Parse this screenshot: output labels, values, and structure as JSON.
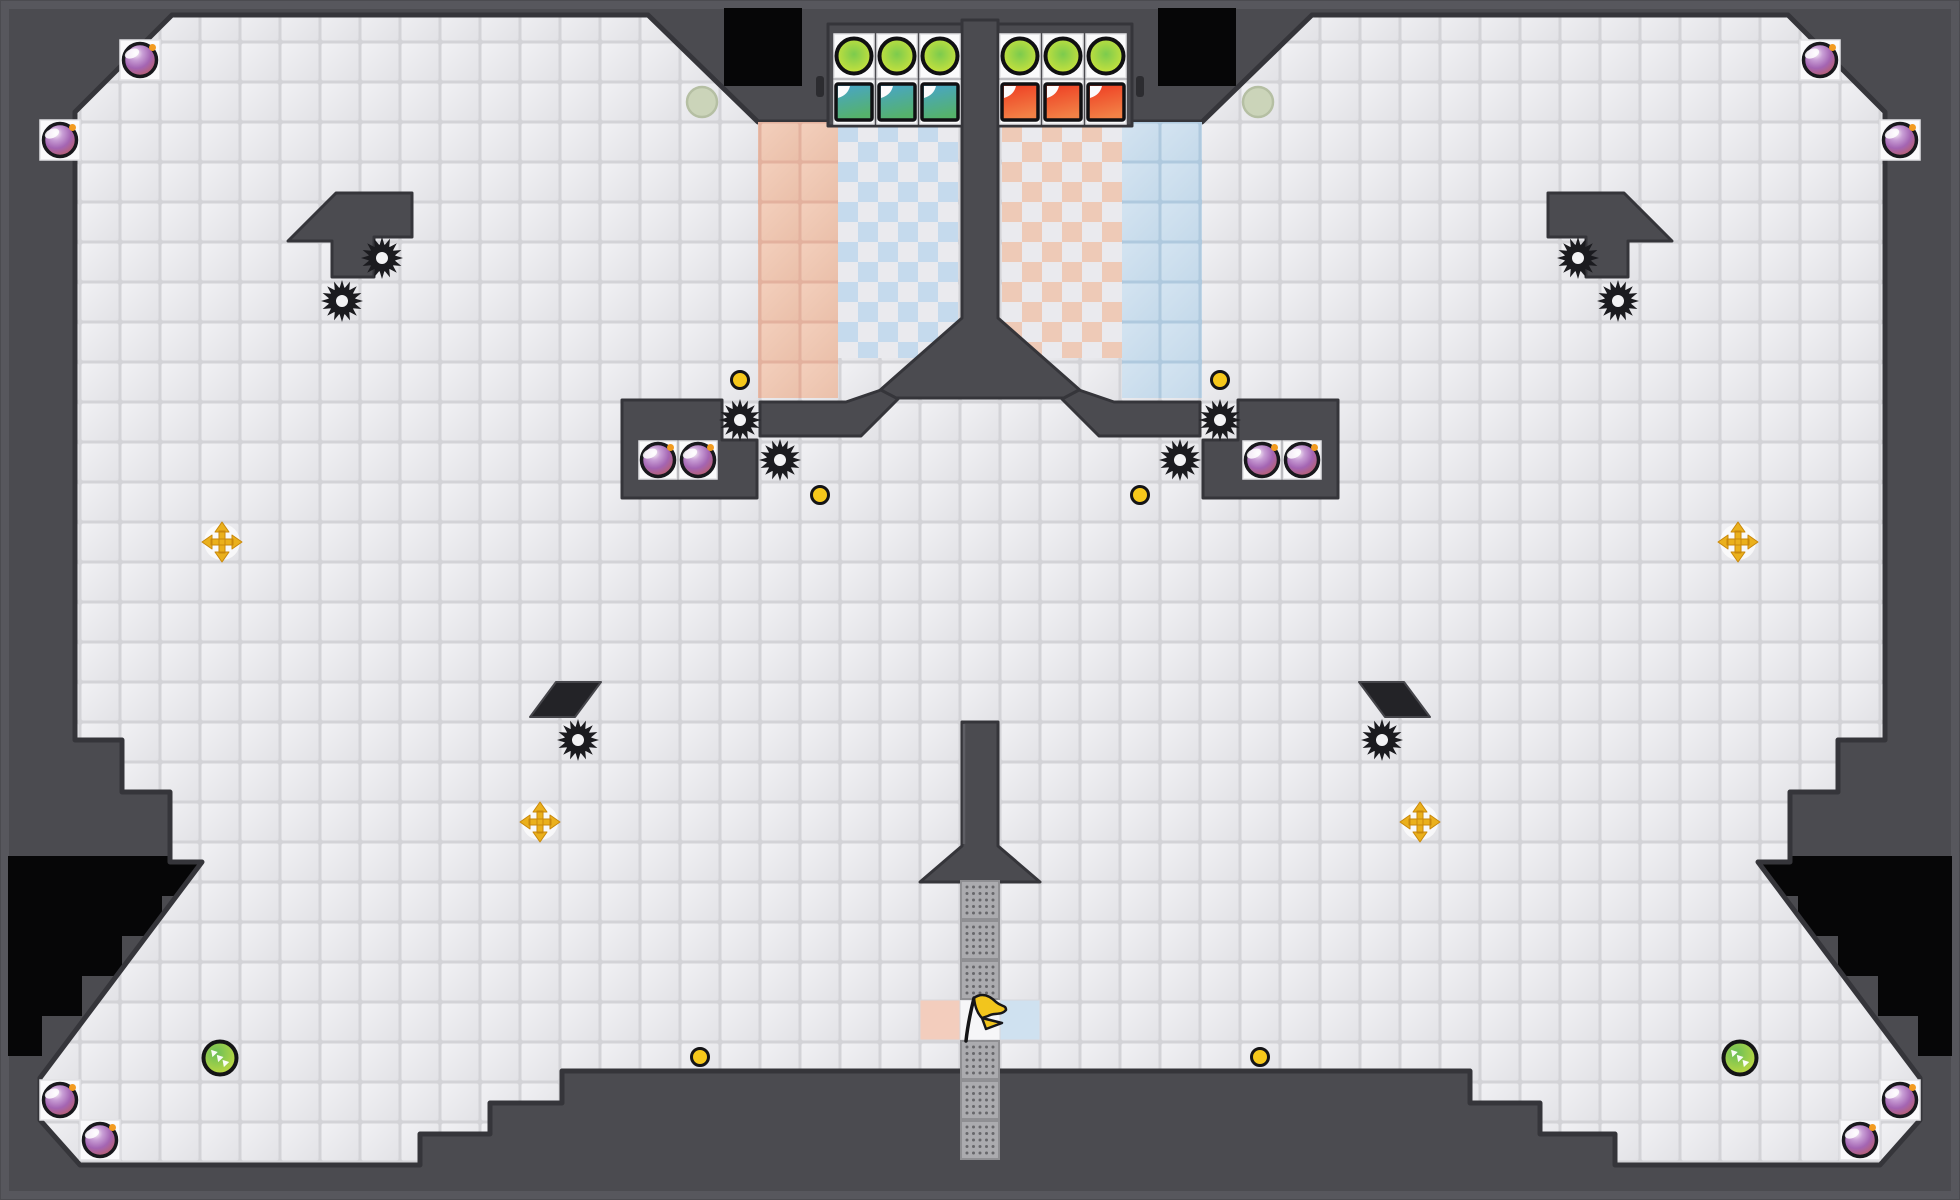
{
  "scene": {
    "width": 1960,
    "height": 1200,
    "mode_hint": "capture-the-flag-arena"
  },
  "colors": {
    "wall": "#4b4b50",
    "wallEdge": "#35353a",
    "wallHi": "#5e5e64",
    "voidBlack": "#060607",
    "rim": "#57575d",
    "tileSeam": "#d3d3d7",
    "tileHi": "#f1f1f4",
    "tileLo": "#e2e2e6",
    "whiteCell": "#fafafb",
    "whiteCellEdge": "#e2e2e5",
    "peachSeam": "#e3b19e",
    "peachA": "#f3cfbc",
    "peachB": "#eabfa9",
    "blueSeam": "#afc9de",
    "blueA": "#d4e4f1",
    "blueB": "#c4d9ea",
    "checkBlue": "#c5daed",
    "checkPeach": "#eecab7",
    "checkBase": "#eaeaee",
    "mesh": "#ababaf",
    "meshEdge": "#8f8f93",
    "meshDot": "#67676b",
    "bombRing": "#19191d",
    "spark": "#f29b1f",
    "coin": "#f6c81b",
    "coinRing": "#141416",
    "gold": "#eab01c",
    "goldEdge": "#c9880b",
    "gear": "#1b1b1f",
    "gearHole": "#f3f3f5",
    "btnIn": "#7ccb4d",
    "btnMid": "#b5dc41",
    "btnOut": "#e9ef2a",
    "tealA": "#47a4cf",
    "tealB": "#55b26b",
    "redA": "#ee3a21",
    "redB": "#f28146",
    "padA": "#6abf58",
    "padB": "#d9e038",
    "pale": "#cbd4b9",
    "paleEdge": "#b5bfa3",
    "pink": "#f3cdbd",
    "lightblue": "#cfe1f0",
    "flagCell": "#f6f6f8",
    "flagYellow": "#f2c51d",
    "sliver": "#232327",
    "bombStops": [
      "#f9f3f7",
      "#c99fd6",
      "#a465b3",
      "#b85f73",
      "#ca6b4e"
    ]
  },
  "level": {
    "cavity_path": "M172,15 L648,15 L758,122 L1202,122 L1312,15 L1788,15 L1885,112 L1885,740 L1838,740 L1838,792 L1790,792 L1790,862 L1758,862 L1920,1078 L1920,1120 L1880,1165 L1615,1165 L1615,1134 L1540,1134 L1540,1103 L1470,1103 L1470,1071 L562,1071 L562,1103 L490,1103 L490,1134 L420,1134 L420,1165 L80,1165 L40,1120 L40,1078 L202,862 L170,862 L170,792 L122,792 L122,740 L75,740 L75,112 Z",
    "voids": [
      {
        "name": "void-top-left",
        "path": "M724,8 h78 v78 h-78 Z"
      },
      {
        "name": "void-top-right",
        "path": "M1158,8 h78 v78 h-78 Z"
      },
      {
        "name": "void-bottom-left",
        "path": "M8,856 L202,856 L202,896 L162,896 L162,936 L122,936 L122,976 L82,976 L82,1016 L42,1016 L42,1056 L8,1056 Z"
      },
      {
        "name": "void-bottom-right",
        "path": "M1952,856 L1758,856 L1758,896 L1798,896 L1798,936 L1838,936 L1838,976 L1878,976 L1878,1016 L1918,1016 L1918,1056 L1952,1056 Z"
      }
    ],
    "zones": [
      {
        "name": "zone-peach-solid-left",
        "x": 758,
        "y": 122,
        "w": 80,
        "h": 276,
        "pat": "patPeach"
      },
      {
        "name": "zone-blue-solid-right",
        "x": 1122,
        "y": 122,
        "w": 80,
        "h": 276,
        "pat": "patBlue"
      },
      {
        "name": "zone-checker-blue-left",
        "x": 838,
        "y": 122,
        "w": 120,
        "h": 236,
        "pat": "patChkL"
      },
      {
        "name": "zone-checker-peach-right",
        "x": 1002,
        "y": 122,
        "w": 120,
        "h": 236,
        "pat": "patChkR"
      }
    ],
    "walls": [
      {
        "name": "base-frame-left",
        "path": "M828,24 h140 v102 h-140 Z"
      },
      {
        "name": "base-frame-right",
        "path": "M992,24 h140 v102 h-140 Z"
      },
      {
        "name": "tunnel-funnel",
        "path": "M962,20 L998,20 L998,318 L1082,392 L1082,398 L878,398 L878,392 L962,318 Z"
      },
      {
        "name": "skirt-bar-left",
        "path": "M760,402 L846,402 L881,390 L898,399 L861,436 L760,436 Z"
      },
      {
        "name": "skirt-bar-right",
        "path": "M1200,402 L1114,402 L1079,390 L1062,399 L1099,436 L1200,436 Z"
      },
      {
        "name": "hook-left",
        "path": "M288,241 L336,193 L412,193 L412,237 L374,237 L374,277 L332,277 L332,241 Z"
      },
      {
        "name": "hook-right",
        "path": "M1672,241 L1624,193 L1548,193 L1548,237 L1586,237 L1586,277 L1628,277 L1628,241 Z"
      },
      {
        "name": "bomb-box-left",
        "path": "M622,400 L722,400 L722,440 L757,440 L757,498 L622,498 Z"
      },
      {
        "name": "bomb-box-right",
        "path": "M1338,400 L1238,400 L1238,440 L1203,440 L1203,498 L1338,498 Z"
      },
      {
        "name": "flag-pillar",
        "path": "M962,722 L998,722 L998,846 L1040,882 L920,882 L962,846 Z"
      }
    ],
    "slivers": [
      {
        "name": "sliver-left",
        "path": "M530,717 L556,682 L601,682 L575,717 Z"
      },
      {
        "name": "sliver-right",
        "path": "M1430,717 L1404,682 L1359,682 L1385,717 Z"
      }
    ],
    "white_cells": [
      [
        120,
        40,
        40,
        40
      ],
      [
        40,
        120,
        40,
        40
      ],
      [
        1800,
        40,
        40,
        40
      ],
      [
        1880,
        120,
        40,
        40
      ],
      [
        40,
        1080,
        40,
        40
      ],
      [
        80,
        1120,
        40,
        40
      ],
      [
        1880,
        1080,
        40,
        40
      ],
      [
        1840,
        1120,
        40,
        40
      ],
      [
        834,
        34,
        40,
        44
      ],
      [
        877,
        34,
        40,
        44
      ],
      [
        920,
        34,
        40,
        44
      ],
      [
        1000,
        34,
        40,
        44
      ],
      [
        1043,
        34,
        40,
        44
      ],
      [
        1086,
        34,
        40,
        44
      ],
      [
        834,
        80,
        40,
        44
      ],
      [
        877,
        80,
        40,
        44
      ],
      [
        920,
        80,
        40,
        44
      ],
      [
        1000,
        80,
        40,
        44
      ],
      [
        1043,
        80,
        40,
        44
      ],
      [
        1086,
        80,
        40,
        44
      ],
      [
        639,
        441,
        38,
        38
      ],
      [
        679,
        441,
        38,
        38
      ],
      [
        1243,
        441,
        38,
        38
      ],
      [
        1283,
        441,
        38,
        38
      ]
    ],
    "accent_tiles": [
      {
        "name": "flag-home-tile",
        "x": 960,
        "y": 1000,
        "w": 40,
        "h": 40,
        "fill": "flagCell"
      },
      {
        "name": "pink-team-tile",
        "x": 920,
        "y": 1000,
        "w": 40,
        "h": 40,
        "fill": "pink"
      },
      {
        "name": "blue-team-tile",
        "x": 1000,
        "y": 1000,
        "w": 40,
        "h": 40,
        "fill": "lightblue"
      }
    ],
    "mesh_cells": [
      [
        960,
        880
      ],
      [
        960,
        920
      ],
      [
        960,
        960
      ],
      [
        960,
        1040
      ],
      [
        960,
        1080
      ],
      [
        960,
        1120
      ]
    ],
    "ticks": [
      [
        816,
        76,
        8,
        21
      ],
      [
        1136,
        76,
        8,
        21
      ]
    ]
  },
  "objects": {
    "bombs": [
      [
        140,
        60
      ],
      [
        60,
        140
      ],
      [
        1820,
        60
      ],
      [
        1900,
        140
      ],
      [
        60,
        1100
      ],
      [
        100,
        1140
      ],
      [
        1900,
        1100
      ],
      [
        1860,
        1140
      ],
      [
        658,
        460
      ],
      [
        698,
        460
      ],
      [
        1262,
        460
      ],
      [
        1302,
        460
      ]
    ],
    "gears": [
      [
        342,
        301
      ],
      [
        382,
        258
      ],
      [
        1618,
        301
      ],
      [
        1578,
        258
      ],
      [
        740,
        420
      ],
      [
        780,
        460
      ],
      [
        1220,
        420
      ],
      [
        1180,
        460
      ],
      [
        578,
        740
      ],
      [
        1382,
        740
      ]
    ],
    "coins": [
      [
        740,
        380
      ],
      [
        1220,
        380
      ],
      [
        820,
        495
      ],
      [
        1140,
        495
      ],
      [
        700,
        1057
      ],
      [
        1260,
        1057
      ]
    ],
    "crosses": [
      [
        222,
        542
      ],
      [
        1738,
        542
      ],
      [
        540,
        822
      ],
      [
        1420,
        822
      ]
    ],
    "boost_pads": [
      [
        220,
        1058
      ],
      [
        1740,
        1058
      ]
    ],
    "inactive_pads": [
      [
        702,
        102
      ],
      [
        1258,
        102
      ]
    ],
    "buttons": [
      [
        854,
        56
      ],
      [
        897,
        56
      ],
      [
        940,
        56
      ],
      [
        1020,
        56
      ],
      [
        1063,
        56
      ],
      [
        1106,
        56
      ]
    ],
    "doors": [
      {
        "x": 854,
        "y": 102,
        "team": "teal"
      },
      {
        "x": 897,
        "y": 102,
        "team": "teal"
      },
      {
        "x": 940,
        "y": 102,
        "team": "teal"
      },
      {
        "x": 1020,
        "y": 102,
        "team": "red"
      },
      {
        "x": 1063,
        "y": 102,
        "team": "red"
      },
      {
        "x": 1106,
        "y": 102,
        "team": "red"
      }
    ],
    "flag": {
      "x": 972,
      "y": 1018
    }
  }
}
